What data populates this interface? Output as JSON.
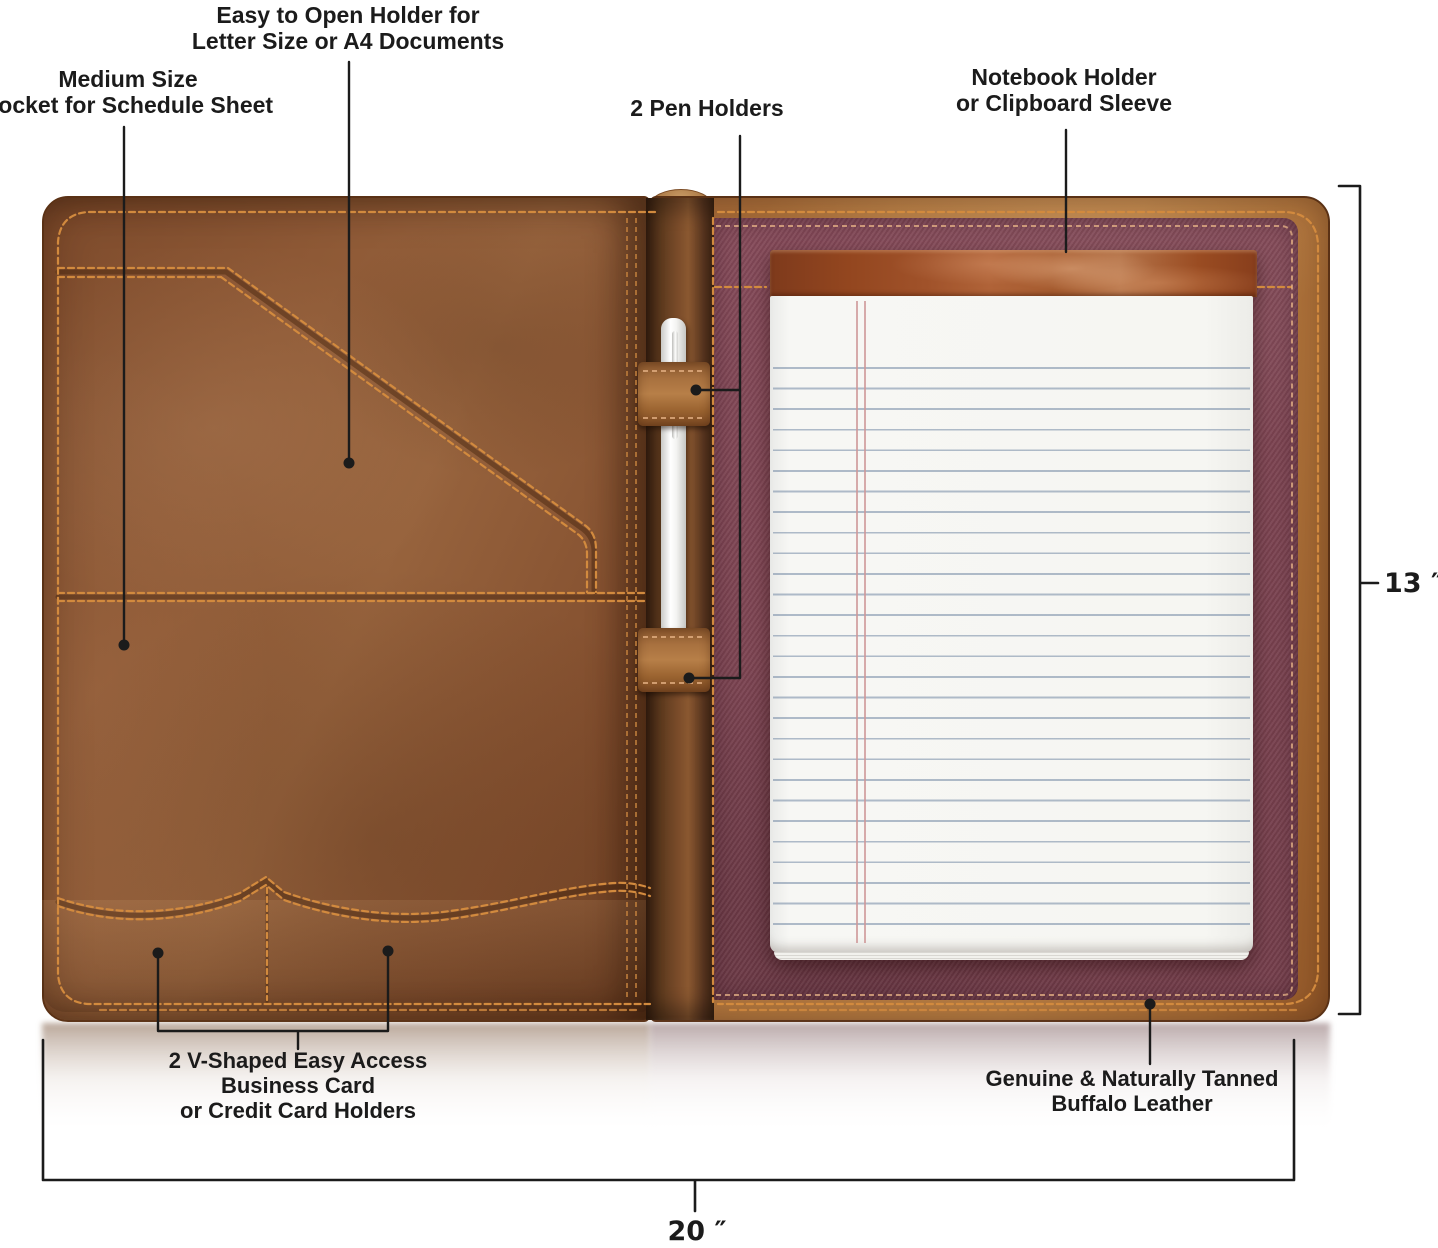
{
  "colors": {
    "leather-tan": "#b0763e",
    "leather-brown": "#8a5634",
    "leather-dark": "#54301a",
    "spine-brown": "#6e4124",
    "stitch": "#d28a3e",
    "stitch-soft": "#e8b487",
    "fabric-maroon": "#7d4452",
    "pad-strip": "#9c4e27",
    "paper": "#f6f6f2",
    "rule-blue": "#a9b9c9",
    "margin-red": "#cf9898",
    "pen-white": "#f4f4f2",
    "annotation": "#1b1b1b"
  },
  "annotations": {
    "easy_open": "Easy to Open Holder for\nLetter Size or A4 Documents",
    "medium_pocket": "Medium Size\nPocket for Schedule Sheet",
    "pen_holders": "2 Pen Holders",
    "notebook_holder": "Notebook Holder\nor Clipboard Sleeve",
    "card_holders": "2 V-Shaped Easy Access\nBusiness Card\nor Credit Card Holders",
    "buffalo_leather": "Genuine & Naturally Tanned\nBuffalo Leather"
  },
  "dimensions": {
    "height_label": "13 ″",
    "width_label": "20 ″"
  }
}
